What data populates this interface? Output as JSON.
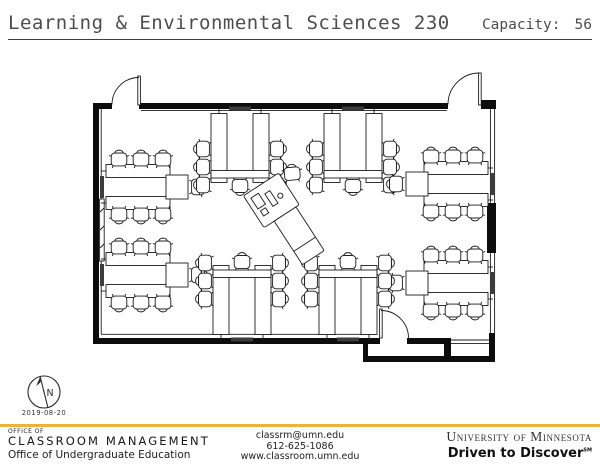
{
  "header": {
    "title": "Learning & Environmental Sciences 230",
    "capacity_label": "Capacity:",
    "capacity_value": "56"
  },
  "plan": {
    "north_label": "N",
    "date": "2019-08-20",
    "capacity": 56,
    "seats_per_table": 7,
    "table_groups": [
      {
        "id": "left-upper",
        "type": "side-u",
        "x": 146,
        "y": 187,
        "rot": 0
      },
      {
        "id": "left-lower",
        "type": "side-u",
        "x": 146,
        "y": 275,
        "rot": 0
      },
      {
        "id": "top-left",
        "type": "u",
        "x": 240,
        "y": 148,
        "rot": 0
      },
      {
        "id": "top-right",
        "type": "u",
        "x": 353,
        "y": 148,
        "rot": 0
      },
      {
        "id": "right-upper",
        "type": "side-u",
        "x": 448,
        "y": 184,
        "rot": 180
      },
      {
        "id": "right-middle",
        "type": "side-u",
        "x": 448,
        "y": 283,
        "rot": 180
      },
      {
        "id": "bottom-left",
        "type": "u",
        "x": 242,
        "y": 300,
        "rot": 180
      },
      {
        "id": "bottom-right",
        "type": "u",
        "x": 348,
        "y": 300,
        "rot": 180
      }
    ],
    "instructor_station": {
      "x": 290,
      "y": 218,
      "rot": -33
    }
  },
  "footer": {
    "left": {
      "line1": "OFFICE OF",
      "line2": "CLASSROOM MANAGEMENT",
      "line3": "Office of Undergraduate Education"
    },
    "center": {
      "email": "classrm@umn.edu",
      "phone": "612-625-1086",
      "website": "www.classroom.umn.edu"
    },
    "right": {
      "university": "University of Minnesota",
      "tagline": "Driven to Discover",
      "tagline_mark": "SM"
    }
  },
  "colors": {
    "accent_gold": "#ECB23D",
    "ink": "#1b1b1b",
    "title_gray": "#4d4d4d"
  }
}
